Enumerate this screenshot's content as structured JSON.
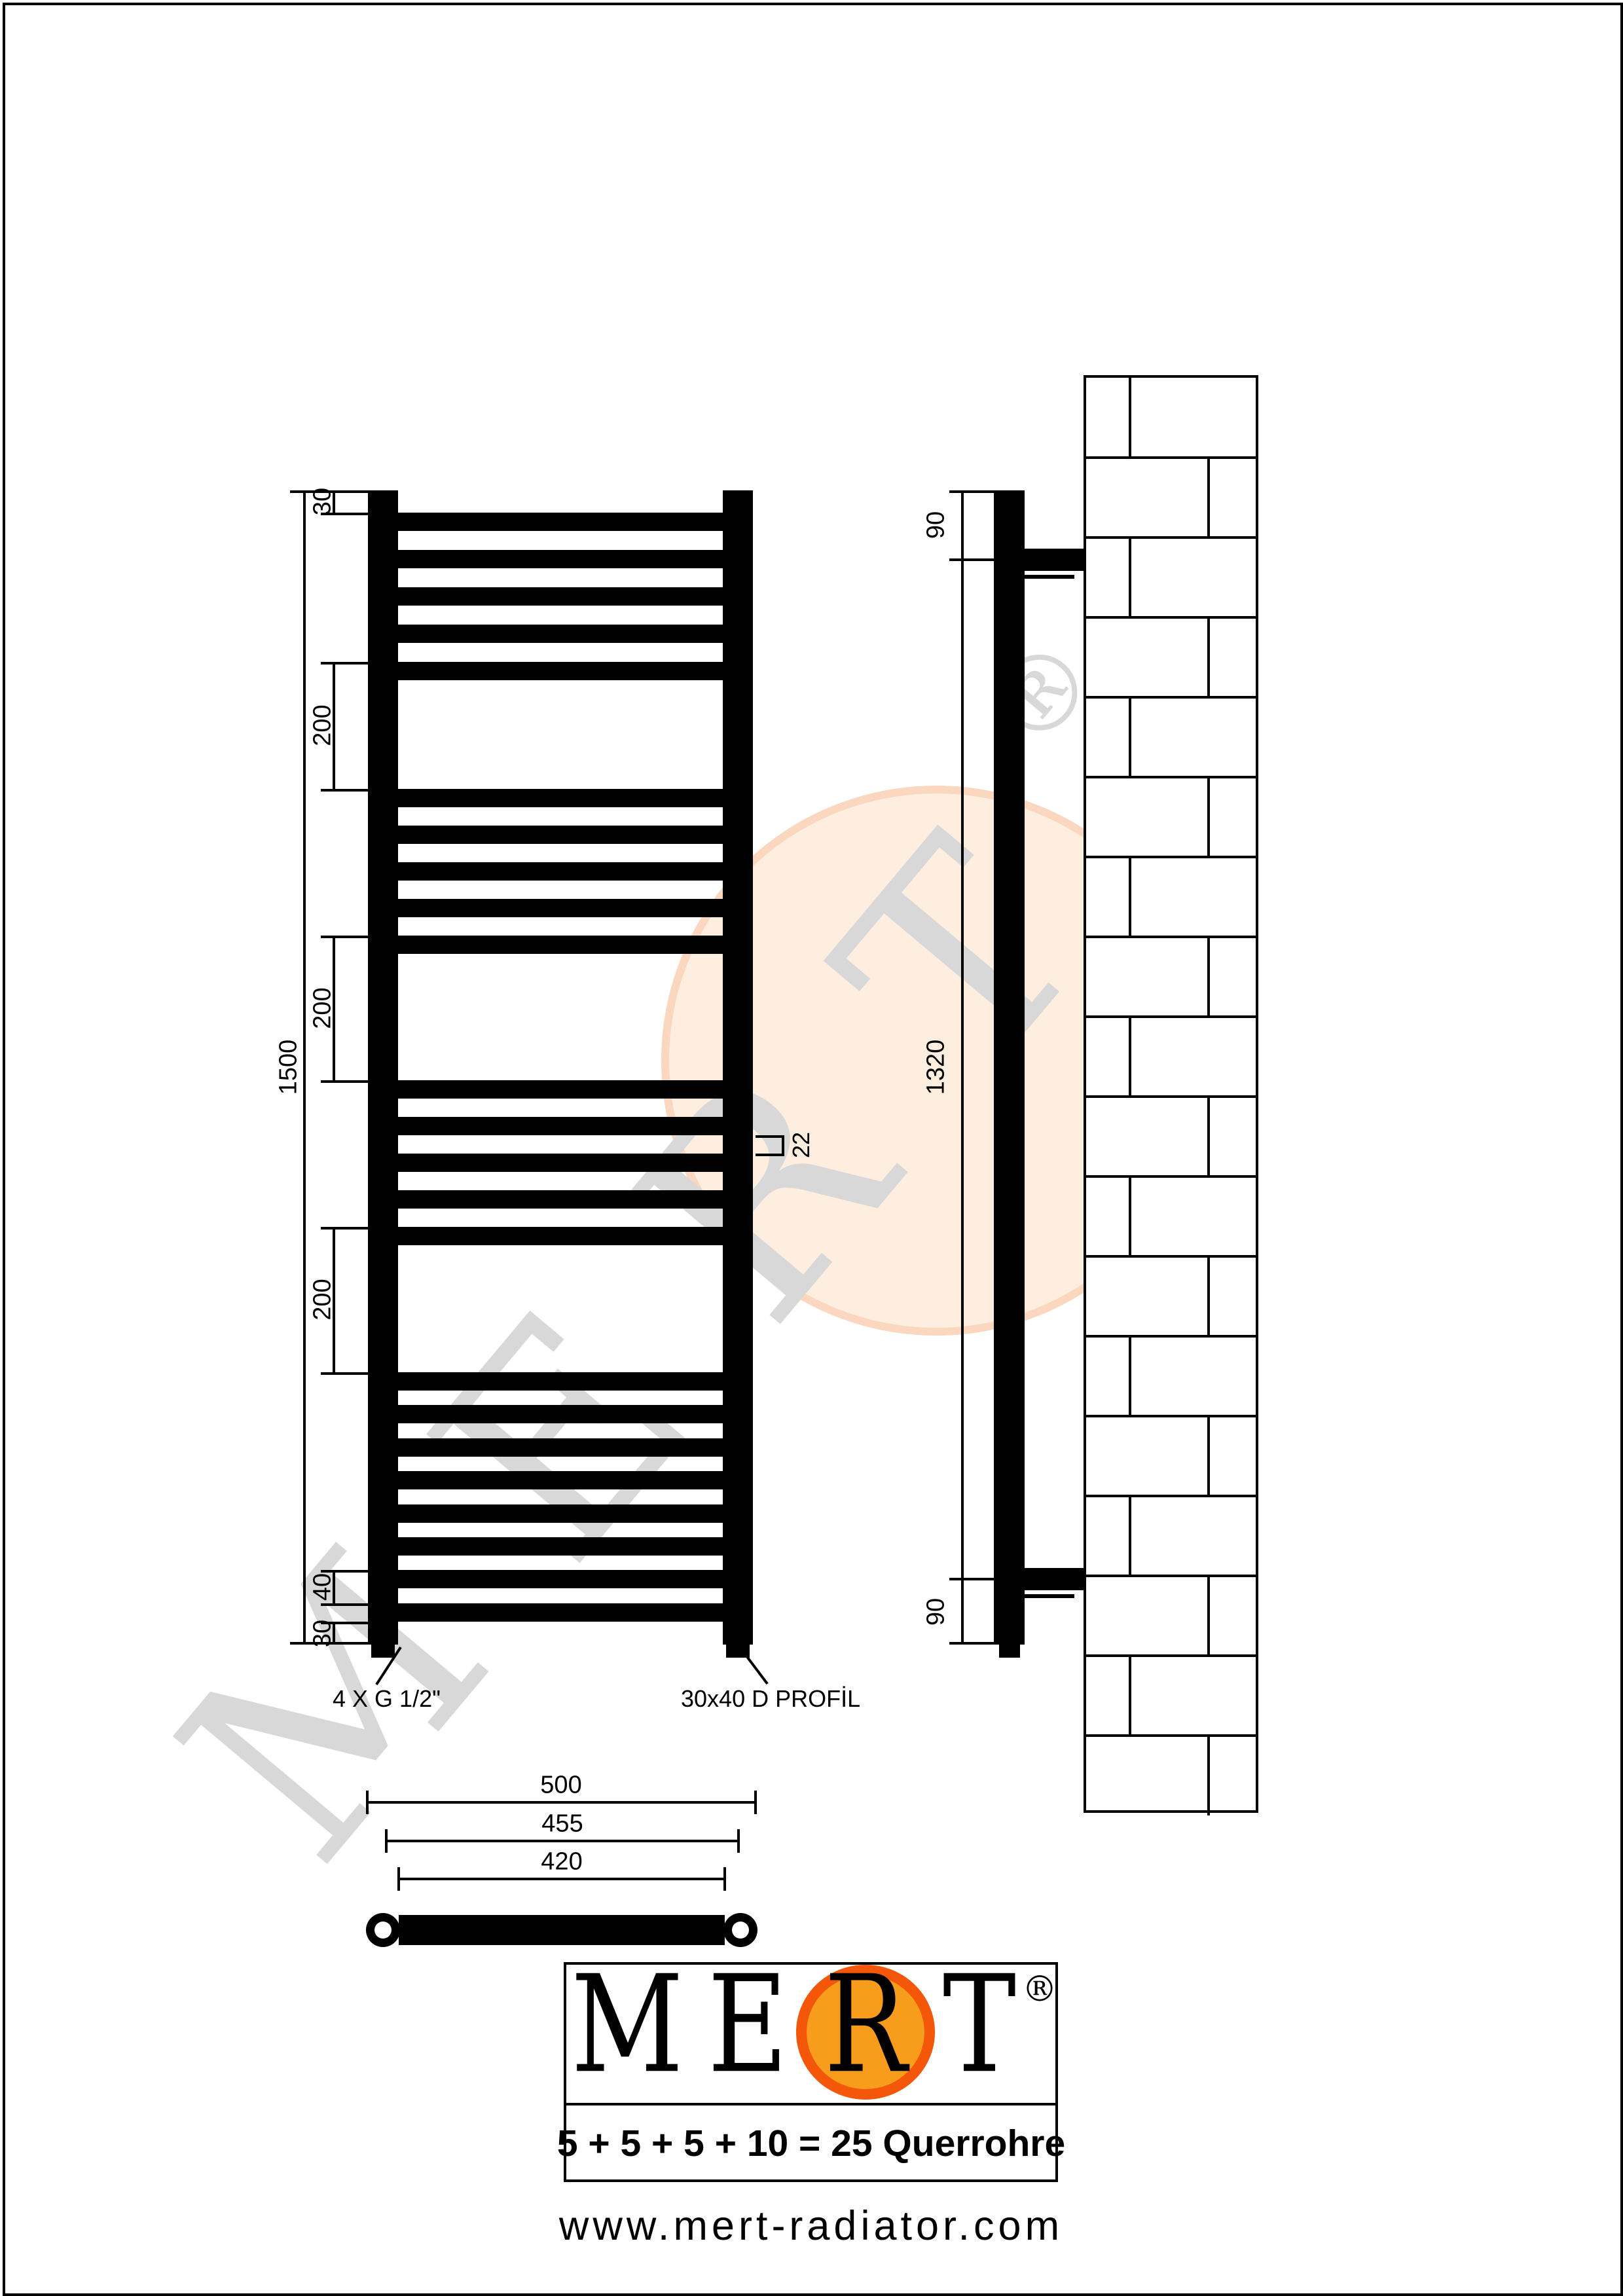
{
  "colors": {
    "ink": "#000000",
    "orange_ring": "#F4570A",
    "orange_fill": "#F89C1C",
    "watermark_gray": "#D8D8D8",
    "watermark_peach_fill": "#FEEEDF",
    "watermark_peach_rim": "#FAD7BE"
  },
  "watermark": {
    "text": "MERT",
    "letters": [
      "M",
      "E",
      "R",
      "T"
    ],
    "registered": "®"
  },
  "dimensions": {
    "front": {
      "top_offset": "30",
      "gap1": "200",
      "gap2": "200",
      "gap3": "200",
      "bottom_pitch": "40",
      "bottom_offset": "30",
      "total_height": "1500",
      "tube_gap": "22"
    },
    "side": {
      "top": "90",
      "middle": "1320",
      "bottom": "90"
    },
    "bottom_view": {
      "overall_width": "500",
      "collector_pitch": "455",
      "tube_length": "420"
    }
  },
  "leaders": {
    "connections": "4 X G 1/2\"",
    "profile": "30x40 D PROFİL"
  },
  "logo": {
    "brand": "MERT",
    "brand_letters": [
      "M",
      "E",
      "R",
      "T"
    ],
    "registered": "®",
    "formula": "5 + 5 + 5 + 10 = 25 Querrohre",
    "website": "www.mert-radiator.com"
  },
  "drawing": {
    "front_tube_groups": [
      5,
      5,
      5,
      8
    ],
    "wall_brick_courses": 18
  }
}
